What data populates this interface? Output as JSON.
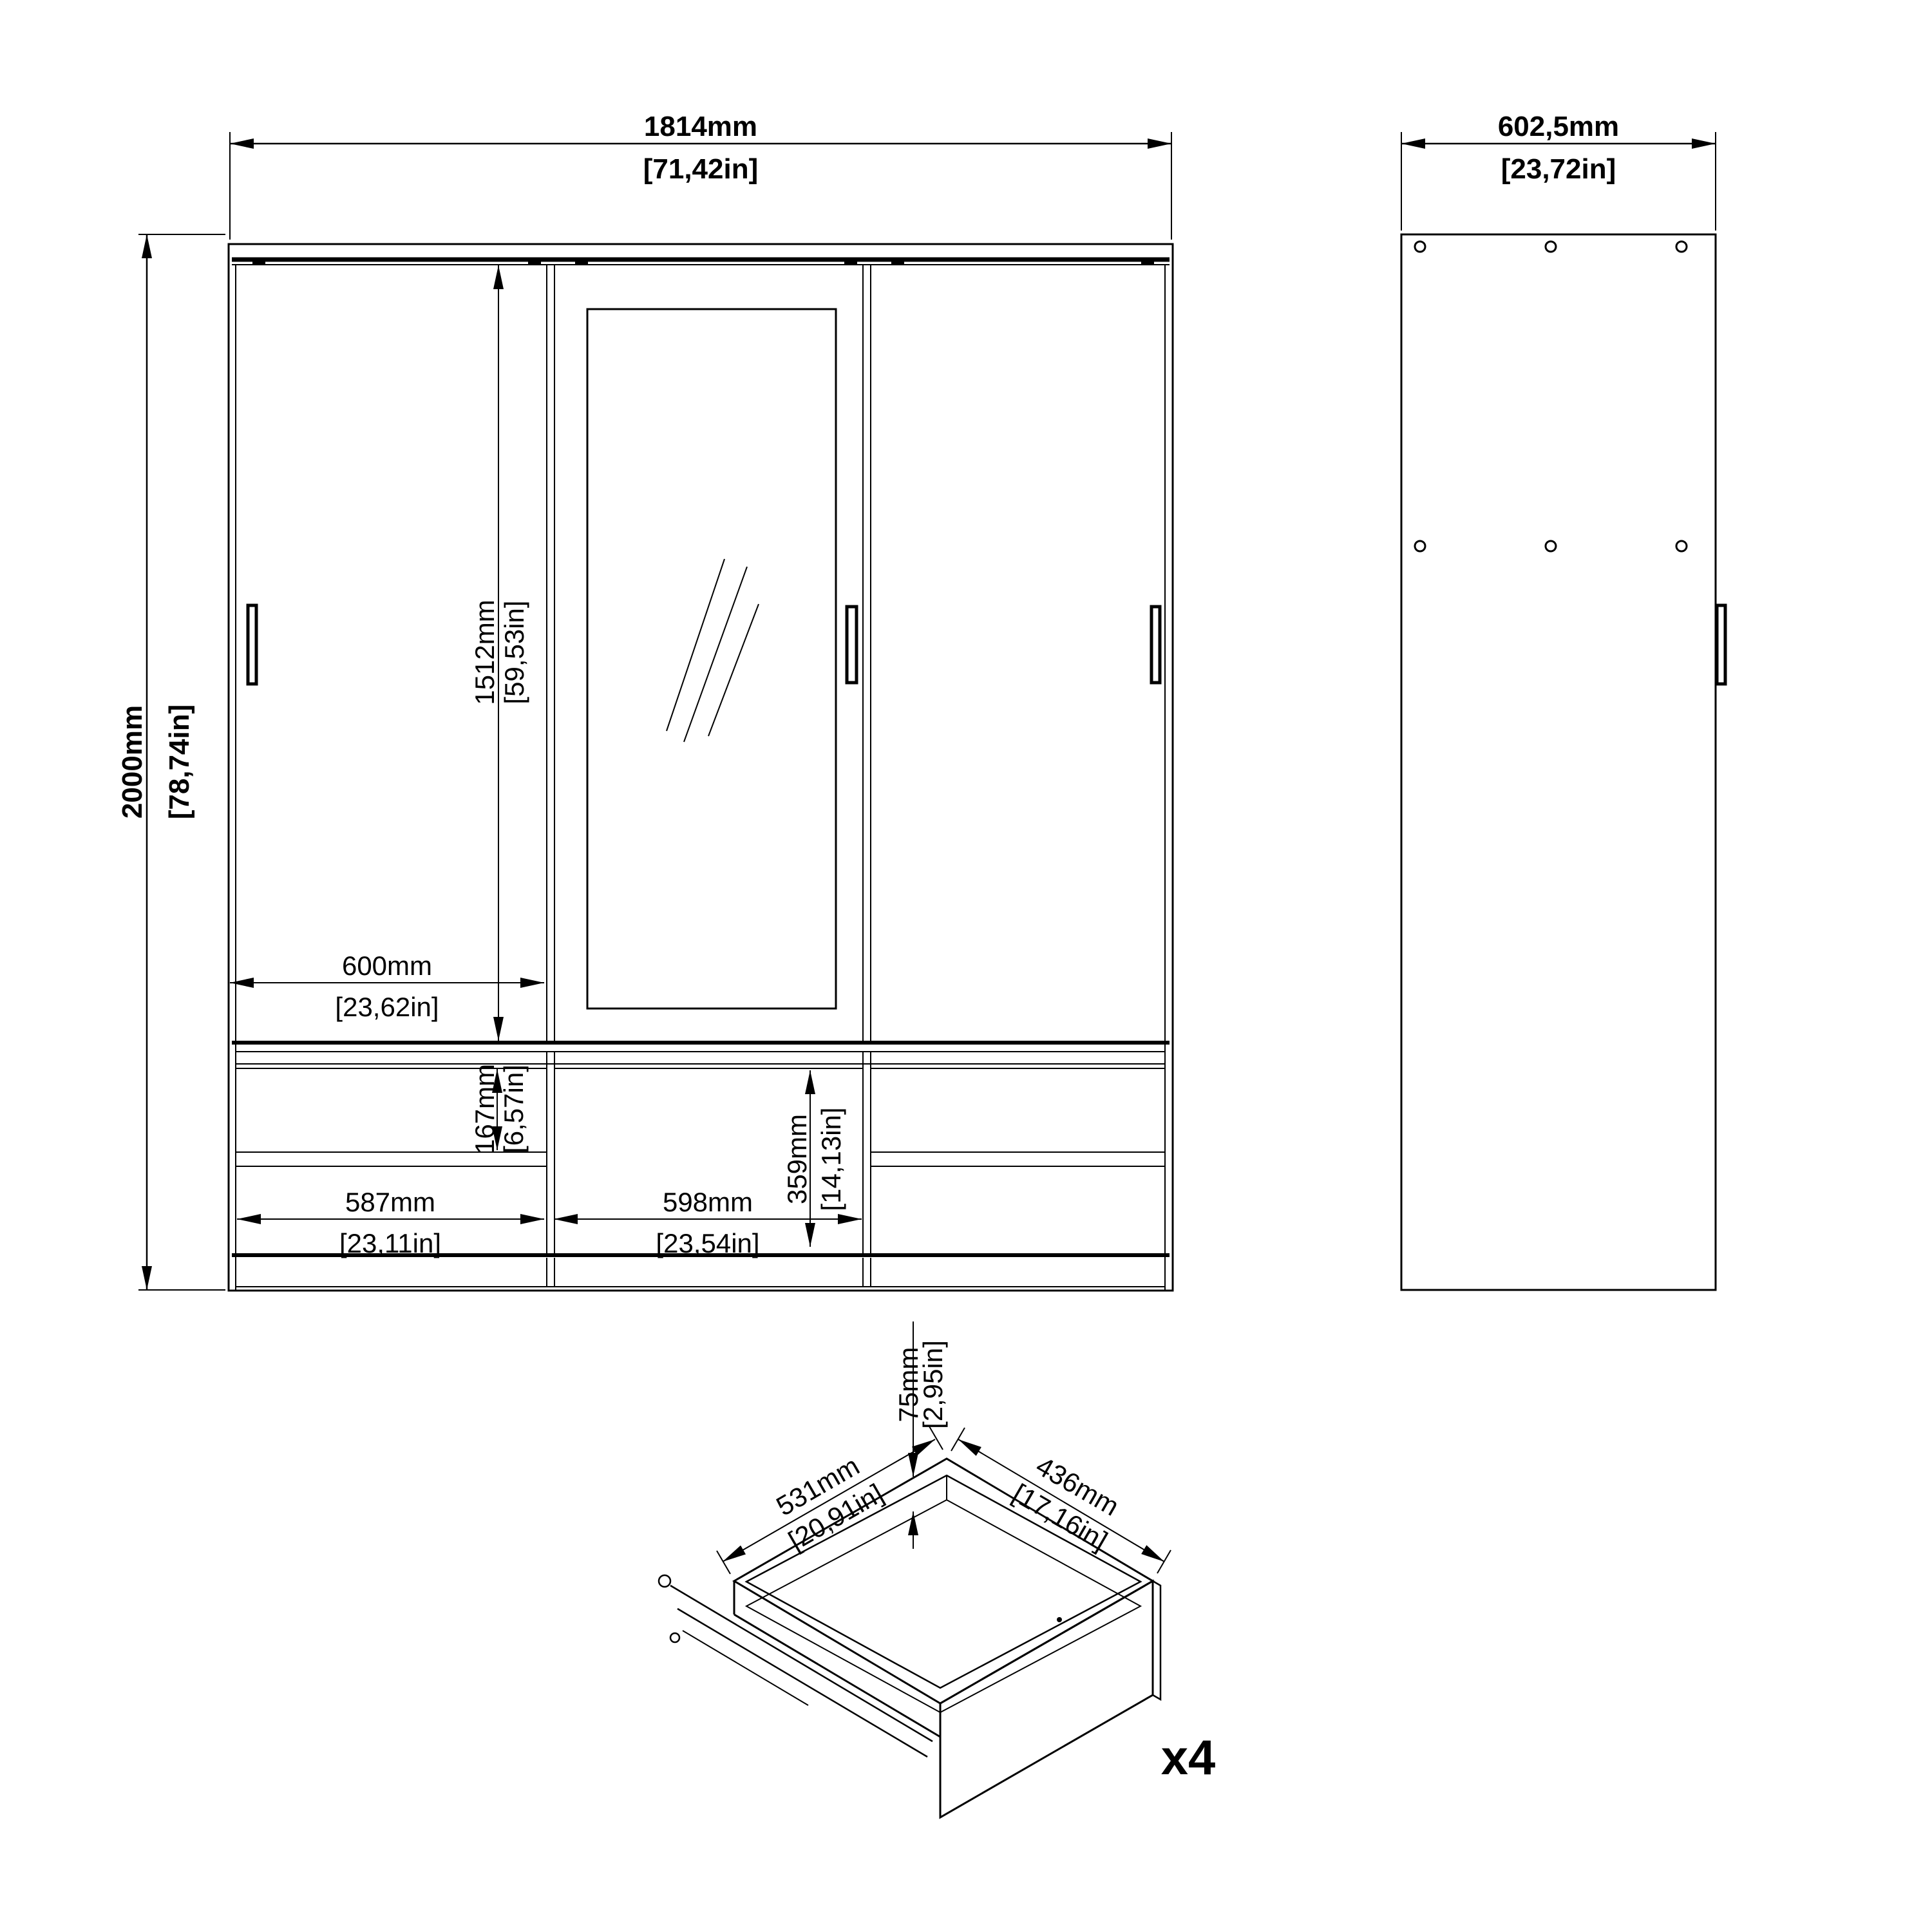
{
  "title": "Wardrobe technical dimension drawing",
  "front_view": {
    "overall_width_mm": "1814mm",
    "overall_width_in": "[71,42in]",
    "overall_height_mm": "2000mm",
    "overall_height_in": "[78,74in]",
    "door_height_mm": "1512mm",
    "door_height_in": "[59,53in]",
    "door_width_mm": "600mm",
    "door_width_in": "[23,62in]",
    "top_drawer_height_mm": "167mm",
    "top_drawer_height_in": "[6,57in]",
    "middle_section_height_mm": "359mm",
    "middle_section_height_in": "[14,13in]",
    "side_drawer_width_mm": "587mm",
    "side_drawer_width_in": "[23,11in]",
    "middle_drawer_width_mm": "598mm",
    "middle_drawer_width_in": "[23,54in]"
  },
  "side_view": {
    "depth_mm": "602,5mm",
    "depth_in": "[23,72in]"
  },
  "drawer_detail": {
    "front_height_mm": "75mm",
    "front_height_in": "[2,95in]",
    "width_mm": "531mm",
    "width_in": "[20,91in]",
    "depth_mm": "436mm",
    "depth_in": "[17,16in]",
    "quantity_label": "x4"
  },
  "colors": {
    "line": "#000000",
    "background": "#ffffff"
  }
}
